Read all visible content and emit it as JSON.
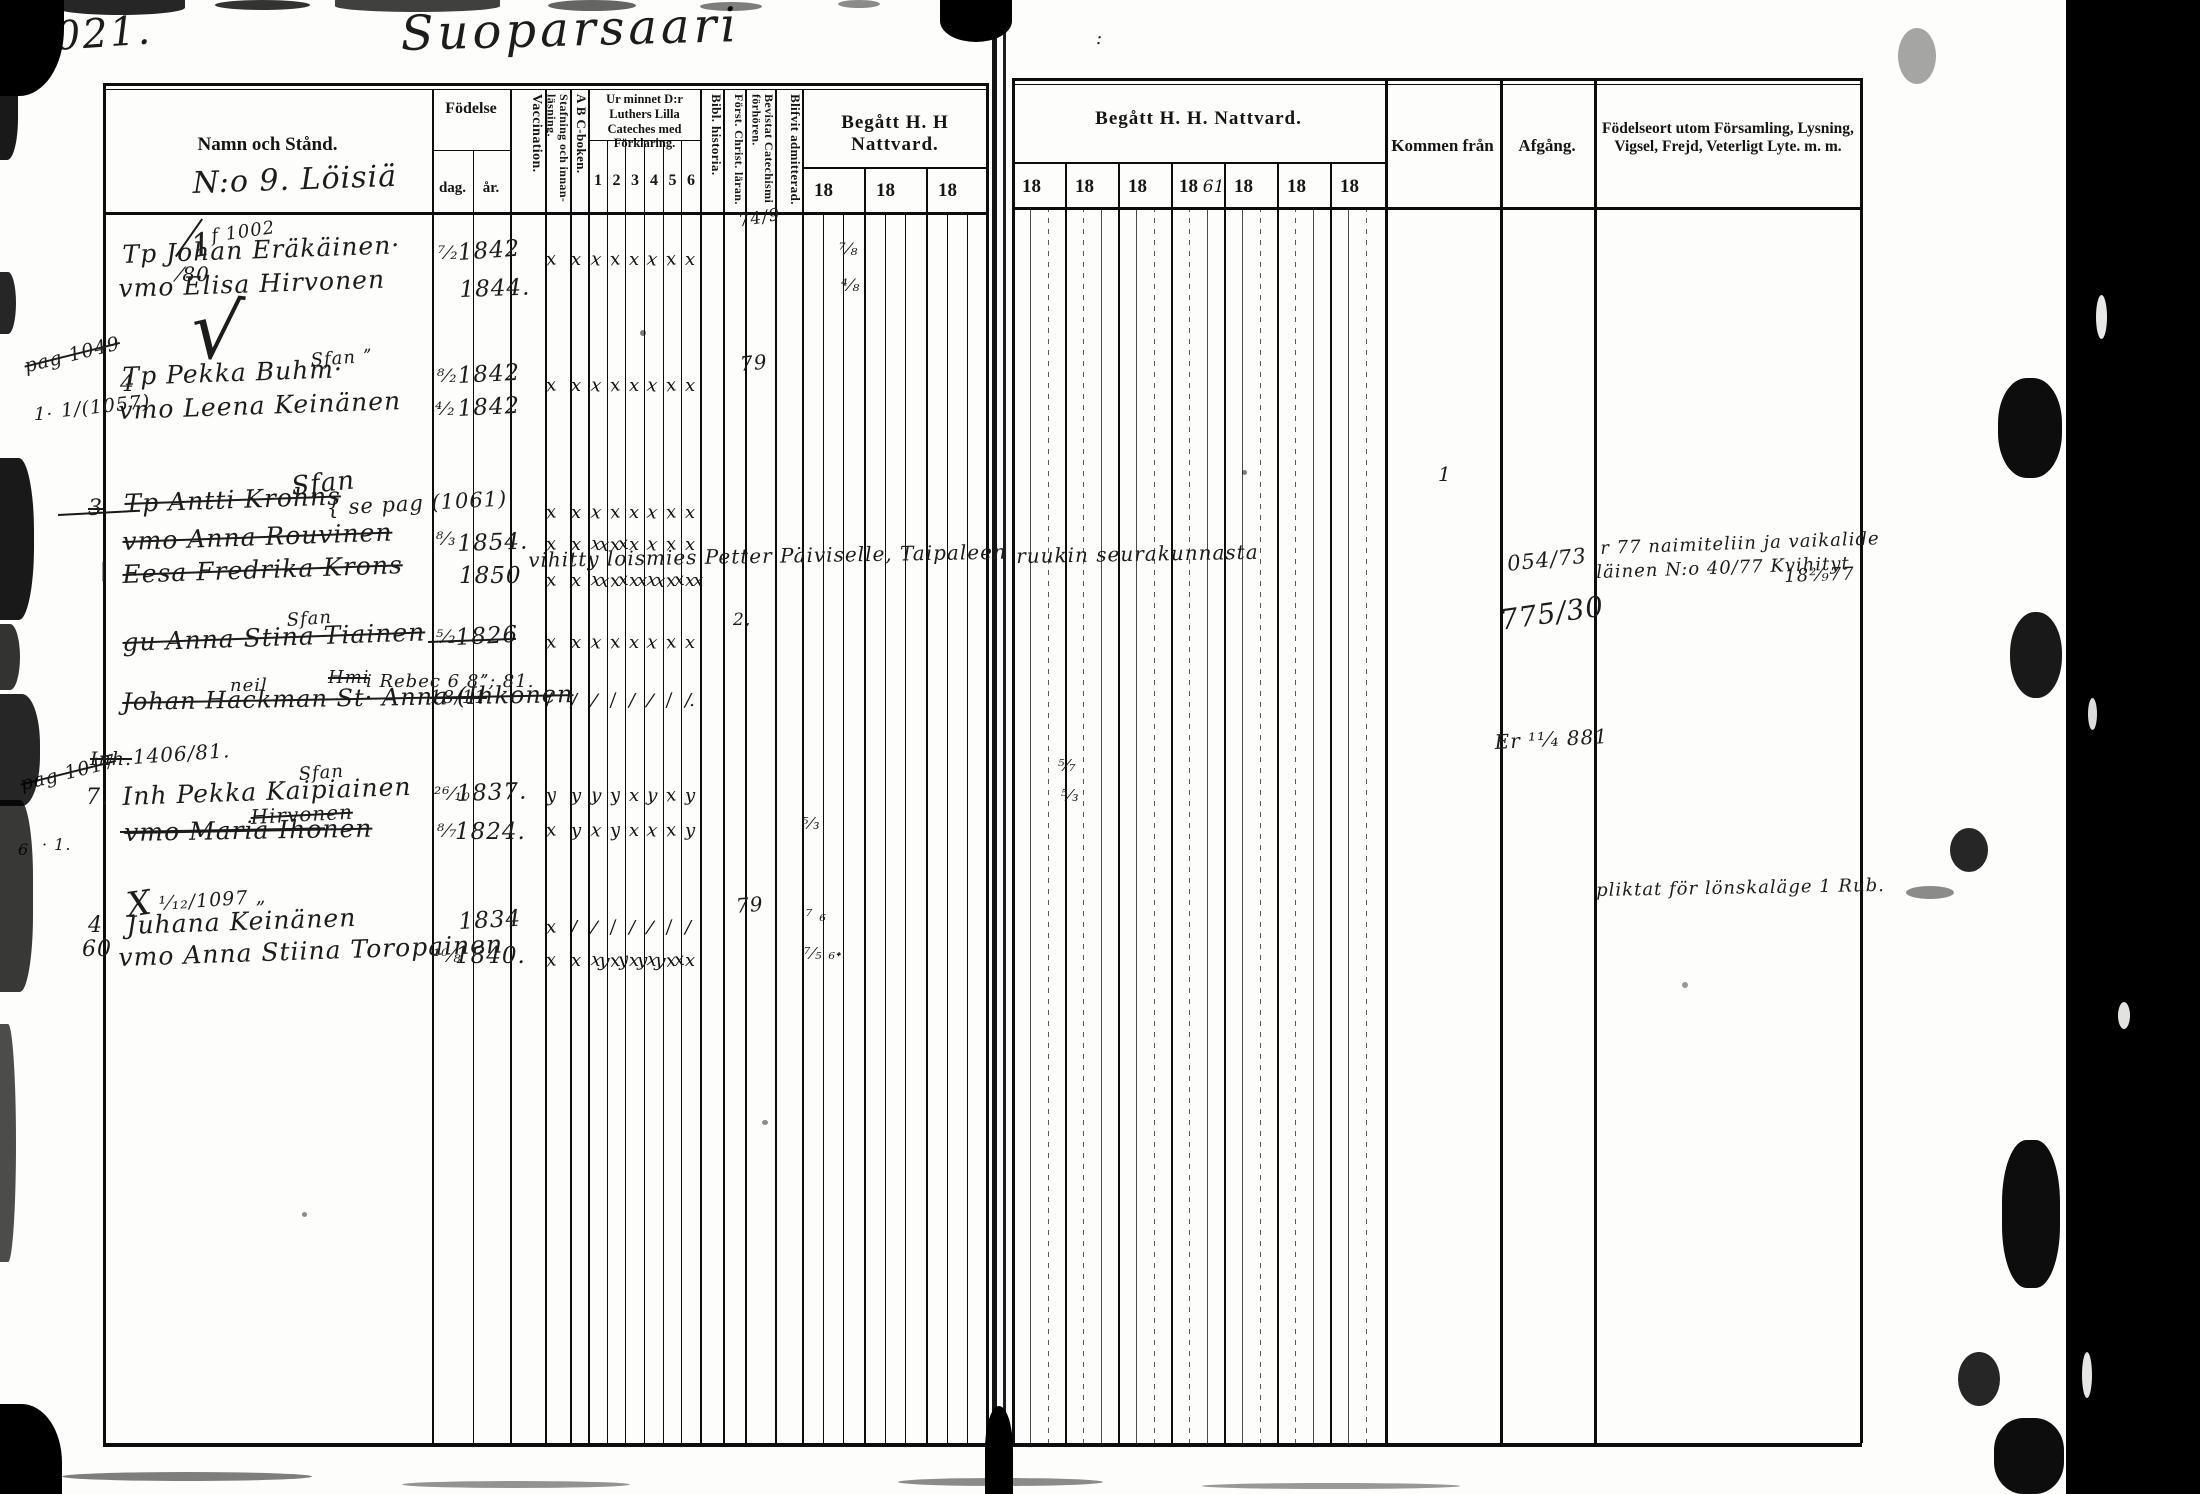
{
  "page": {
    "folio": "1021.",
    "title": "Suoparsaari"
  },
  "colors": {
    "ink": "#1c1c1c",
    "paper": "#fdfdfb",
    "scan_border": "#000000"
  },
  "lh": {
    "namn": "Namn och Stånd.",
    "namn_sub": "N:o 9. Löisiä",
    "fodelse": "Födelse",
    "dag": "dag.",
    "ar": "år.",
    "vacc": "Vaccination.",
    "staf": "Stafning och innan-läsning.",
    "abc": "A B C-boken.",
    "urminnet": "Ur minnet D:r Luthers Lilla Cateches med Förklaring.",
    "cols": [
      "1",
      "2",
      "3",
      "4",
      "5",
      "6"
    ],
    "bibl": "Bibl. historia.",
    "forst": "Först. Christ. läran.",
    "bev": "Bevistat Catechismi förhören.",
    "blif": "Blifvit admitterad.",
    "begatt": "Begått H. H Nattvard.",
    "years": [
      "18",
      "18",
      "18"
    ]
  },
  "rh": {
    "begatt": "Begått H. H. Nattvard.",
    "years": [
      "18",
      "18",
      "18",
      "18",
      "18",
      "18",
      "18"
    ],
    "year4_note": "61",
    "kommen": "Kommen från",
    "afgang": "Afgång.",
    "fodelseort1": "Födelseort utom Församling, Lysning,",
    "fodelseort2": "Vigsel, Frejd, Veterligt Lyte. m. m."
  },
  "handwriting": [
    {
      "x": 210,
      "y": 226,
      "t": "f 1002",
      "fs": 18,
      "r": -8
    },
    {
      "x": 122,
      "y": 240,
      "t": "Tp Johan Eräkäinen·",
      "fs": 25,
      "r": -2
    },
    {
      "x": 438,
      "y": 243,
      "t": "⁷⁄₂",
      "fs": 18
    },
    {
      "x": 457,
      "y": 240,
      "t": "1842",
      "fs": 23,
      "r": -4
    },
    {
      "x": 118,
      "y": 274,
      "t": "vmo Elisa Hirvonen",
      "fs": 25,
      "r": -2
    },
    {
      "x": 459,
      "y": 277,
      "t": "1844.",
      "fs": 23,
      "r": -2
    },
    {
      "x": 196,
      "y": 282,
      "t": "√",
      "fs": 80,
      "r": 6
    },
    {
      "x": 188,
      "y": 228,
      "t": "1",
      "fs": 32,
      "r": -10
    },
    {
      "x": 178,
      "y": 262,
      "t": "⁄80",
      "fs": 20
    },
    {
      "x": 22,
      "y": 356,
      "t": "pag 1049",
      "fs": 19,
      "r": -14,
      "s": 1
    },
    {
      "x": 120,
      "y": 372,
      "t": "4",
      "fs": 22
    },
    {
      "x": 34,
      "y": 404,
      "t": "1·",
      "fs": 18
    },
    {
      "x": 60,
      "y": 400,
      "t": "1/(1057)",
      "fs": 19,
      "r": -6
    },
    {
      "x": 122,
      "y": 362,
      "t": "Tp Pekka Buhm·",
      "fs": 25,
      "r": -2
    },
    {
      "x": 310,
      "y": 350,
      "t": "Sfan ˮ",
      "fs": 18,
      "r": -4
    },
    {
      "x": 437,
      "y": 366,
      "t": "⁸⁄₂",
      "fs": 18
    },
    {
      "x": 457,
      "y": 363,
      "t": "1842",
      "fs": 23,
      "r": -3
    },
    {
      "x": 118,
      "y": 396,
      "t": "vmo Leena Keinänen",
      "fs": 25,
      "r": -2
    },
    {
      "x": 435,
      "y": 399,
      "t": "⁴⁄₂",
      "fs": 18
    },
    {
      "x": 457,
      "y": 396,
      "t": "1842",
      "fs": 23,
      "r": -3
    },
    {
      "x": 88,
      "y": 496,
      "t": "3",
      "fs": 22,
      "s": 1
    },
    {
      "x": 124,
      "y": 489,
      "t": "Tp Antti Krohns",
      "fs": 25,
      "r": -2,
      "s": 1
    },
    {
      "x": 290,
      "y": 472,
      "t": "Sfan",
      "fs": 26,
      "r": -6
    },
    {
      "x": 326,
      "y": 496,
      "t": "{ se pag (1061)",
      "fs": 21,
      "r": -3
    },
    {
      "x": 122,
      "y": 527,
      "t": "vmo Anna Rouvinen",
      "fs": 25,
      "r": -2,
      "s": 1
    },
    {
      "x": 436,
      "y": 529,
      "t": "⁸⁄₃",
      "fs": 18
    },
    {
      "x": 457,
      "y": 531,
      "t": "1854.",
      "fs": 23,
      "r": -2
    },
    {
      "x": 122,
      "y": 560,
      "t": "Eesa Fredrika Krons",
      "fs": 25,
      "r": -2,
      "s": 1
    },
    {
      "x": 459,
      "y": 563,
      "t": "1850",
      "fs": 23
    },
    {
      "x": 100,
      "y": 558,
      "t": "|",
      "fs": 20
    },
    {
      "x": 286,
      "y": 610,
      "t": "Sfan",
      "fs": 18,
      "r": -4
    },
    {
      "x": 122,
      "y": 628,
      "t": "gu Anna Stina Tiainen",
      "fs": 25,
      "r": -2,
      "s": 1
    },
    {
      "x": 436,
      "y": 627,
      "t": "⁵⁄₂",
      "fs": 18
    },
    {
      "x": 455,
      "y": 625,
      "t": "1826",
      "fs": 23,
      "r": -3
    },
    {
      "x": 230,
      "y": 675,
      "t": "neil",
      "fs": 18
    },
    {
      "x": 328,
      "y": 667,
      "t": "Hmi",
      "fs": 18,
      "s": 1
    },
    {
      "x": 366,
      "y": 671,
      "t": "i Rebec 6 8ˮ; 81.",
      "fs": 18
    },
    {
      "x": 122,
      "y": 688,
      "t": "Johan Hackman St· Anna (Ihkonen",
      "fs": 24,
      "r": -1,
      "s": 1
    },
    {
      "x": 430,
      "y": 687,
      "t": "18/11",
      "fs": 18,
      "s": 1
    },
    {
      "x": 90,
      "y": 748,
      "t": "Inh.",
      "fs": 19,
      "s": 1
    },
    {
      "x": 132,
      "y": 745,
      "t": "1406/81.",
      "fs": 20,
      "r": -4
    },
    {
      "x": 18,
      "y": 774,
      "t": "pag 1017",
      "fs": 19,
      "r": -14,
      "s": 1
    },
    {
      "x": 86,
      "y": 785,
      "t": "7.",
      "fs": 22
    },
    {
      "x": 122,
      "y": 782,
      "t": "Inh Pekka Kaipiainen",
      "fs": 25,
      "r": -2
    },
    {
      "x": 298,
      "y": 764,
      "t": "Sfan",
      "fs": 18,
      "r": -4
    },
    {
      "x": 434,
      "y": 784,
      "t": "²⁶⁄₁₀",
      "fs": 18
    },
    {
      "x": 456,
      "y": 781,
      "t": "1837.",
      "fs": 23,
      "r": -2
    },
    {
      "x": 250,
      "y": 805,
      "t": "Hirvonen",
      "fs": 20,
      "r": -3,
      "s": 1
    },
    {
      "x": 124,
      "y": 818,
      "t": "vmo Maria Ihonen",
      "fs": 25,
      "r": -1,
      "s": 1
    },
    {
      "x": 437,
      "y": 821,
      "t": "⁸⁄₇",
      "fs": 18
    },
    {
      "x": 455,
      "y": 819,
      "t": "1824.",
      "fs": 23
    },
    {
      "x": 18,
      "y": 840,
      "t": "6",
      "fs": 16
    },
    {
      "x": 42,
      "y": 835,
      "t": "· 1.",
      "fs": 16
    },
    {
      "x": 124,
      "y": 886,
      "t": "X",
      "fs": 34,
      "r": -8
    },
    {
      "x": 158,
      "y": 893,
      "t": "¹⁄₁₂/1097 „",
      "fs": 19,
      "r": -4
    },
    {
      "x": 88,
      "y": 913,
      "t": "4",
      "fs": 22
    },
    {
      "x": 82,
      "y": 937,
      "t": "60",
      "fs": 22
    },
    {
      "x": 126,
      "y": 911,
      "t": "Juhana Keinänen",
      "fs": 25,
      "r": -2
    },
    {
      "x": 458,
      "y": 909,
      "t": "1834",
      "fs": 23,
      "r": -3
    },
    {
      "x": 118,
      "y": 943,
      "t": "vmo Anna Stiina Toropainen",
      "fs": 25,
      "r": -2
    },
    {
      "x": 433,
      "y": 946,
      "t": "¹⁰⁄₈",
      "fs": 18
    },
    {
      "x": 455,
      "y": 943,
      "t": "1840.",
      "fs": 23
    },
    {
      "x": 528,
      "y": 548,
      "t": "vihitty loismies Petter Päiviselle, Taipaleen",
      "fs": 20,
      "r": -1
    },
    {
      "x": 1016,
      "y": 544,
      "t": "ruukin seurakunnasta",
      "fs": 20,
      "r": -1
    },
    {
      "x": 737,
      "y": 212,
      "t": "74/9·",
      "fs": 17,
      "r": -10
    },
    {
      "x": 839,
      "y": 240,
      "t": "⁷⁄₈",
      "fs": 17
    },
    {
      "x": 841,
      "y": 276,
      "t": "⁴⁄₈",
      "fs": 17
    },
    {
      "x": 739,
      "y": 352,
      "t": "79",
      "fs": 20,
      "r": -5
    },
    {
      "x": 733,
      "y": 610,
      "t": "2,",
      "fs": 17
    },
    {
      "x": 802,
      "y": 814,
      "t": "⁵⁄₃",
      "fs": 16
    },
    {
      "x": 1058,
      "y": 756,
      "t": "⁵⁄₇",
      "fs": 16
    },
    {
      "x": 1061,
      "y": 786,
      "t": "⁵⁄₃",
      "fs": 16
    },
    {
      "x": 735,
      "y": 894,
      "t": "79",
      "fs": 20,
      "r": -5
    },
    {
      "x": 806,
      "y": 906,
      "t": "⁷ ₆",
      "fs": 16
    },
    {
      "x": 804,
      "y": 944,
      "t": "⁷⁄₅ ₆˖",
      "fs": 16
    },
    {
      "x": 1438,
      "y": 462,
      "t": "1",
      "fs": 20
    },
    {
      "x": 1506,
      "y": 552,
      "t": "054/73",
      "fs": 21,
      "r": -6
    },
    {
      "x": 1498,
      "y": 604,
      "t": "775/30",
      "fs": 28,
      "r": -8
    },
    {
      "x": 1494,
      "y": 730,
      "t": "Er ¹¹⁄₄ 881",
      "fs": 20,
      "r": -3
    },
    {
      "x": 1600,
      "y": 538,
      "t": "r 77 naimiteliin ja vaikalide",
      "fs": 18,
      "r": -2
    },
    {
      "x": 1596,
      "y": 562,
      "t": "läinen N:o 40/77 Kvihityt",
      "fs": 18,
      "r": -2
    },
    {
      "x": 1784,
      "y": 566,
      "t": "18²⁄₉77",
      "fs": 18,
      "r": -2
    },
    {
      "x": 1596,
      "y": 880,
      "t": "pliktat för lönskaläge 1 Rub.",
      "fs": 18,
      "r": -1
    },
    {
      "x": 1096,
      "y": 28,
      "t": ":",
      "fs": 18
    }
  ],
  "marks": {
    "cols": [
      546,
      571,
      591,
      610,
      629,
      647,
      666,
      685
    ],
    "rows": [
      {
        "y": 249,
        "g": [
          "x",
          "x",
          "x",
          "x",
          "x",
          "x",
          "x",
          "x"
        ]
      },
      {
        "y": 375,
        "g": [
          "x",
          "x",
          "x",
          "x",
          "x",
          "x",
          "x",
          "x"
        ]
      },
      {
        "y": 502,
        "g": [
          "x",
          "x",
          "x",
          "x",
          "x",
          "x",
          "x",
          "x"
        ]
      },
      {
        "y": 534,
        "g": [
          "x",
          "x",
          "xx",
          "xx",
          "x",
          "x",
          "x",
          "x"
        ]
      },
      {
        "y": 570,
        "g": [
          "x",
          "x",
          "xx",
          "xx",
          "xx",
          "xx",
          "xx",
          "xx"
        ]
      },
      {
        "y": 632,
        "g": [
          "x",
          "x",
          "x",
          "x",
          "x",
          "x",
          "x",
          "x"
        ]
      },
      {
        "y": 690,
        "g": [
          "/",
          "/",
          "/",
          "/",
          "/",
          "/",
          "/",
          "/."
        ]
      },
      {
        "y": 785,
        "g": [
          "y",
          "y",
          "y",
          "y",
          "x",
          "y",
          "x",
          "y"
        ]
      },
      {
        "y": 820,
        "g": [
          "x",
          "y",
          "x",
          "y",
          "x",
          "x",
          "x",
          "y"
        ]
      },
      {
        "y": 917,
        "g": [
          "x",
          "/",
          "/",
          "/",
          "/",
          "/",
          "/",
          "/"
        ]
      },
      {
        "y": 950,
        "g": [
          "x",
          "x",
          "xy",
          "xy",
          "xy",
          "xy",
          "xx",
          "x"
        ]
      }
    ]
  },
  "strikes": [
    {
      "x": 175,
      "y": 256,
      "w": 46,
      "r": -55
    },
    {
      "x": 120,
      "y": 831,
      "w": 205,
      "r": -1
    },
    {
      "x": 58,
      "y": 514,
      "w": 82,
      "r": -3
    },
    {
      "x": 428,
      "y": 641,
      "w": 88,
      "r": -2
    }
  ],
  "noise": [
    {
      "x": 0,
      "y": 0,
      "w": 64,
      "h": 96,
      "br": "0 0 70% 0",
      "o": 1
    },
    {
      "x": 0,
      "y": 90,
      "w": 18,
      "h": 70,
      "br": "0 0 60% 0",
      "o": 0.9
    },
    {
      "x": 55,
      "y": 0,
      "w": 130,
      "h": 15,
      "br": "0 0 50% 50%",
      "o": 0.85
    },
    {
      "x": 215,
      "y": 0,
      "w": 95,
      "h": 10,
      "br": "50%",
      "o": 0.8
    },
    {
      "x": 335,
      "y": 0,
      "w": 165,
      "h": 12,
      "br": "0 0 50% 50%",
      "o": 0.75
    },
    {
      "x": 548,
      "y": 0,
      "w": 88,
      "h": 11,
      "br": "50%",
      "o": 0.6
    },
    {
      "x": 700,
      "y": 2,
      "w": 62,
      "h": 9,
      "br": "50%",
      "o": 0.5
    },
    {
      "x": 838,
      "y": 0,
      "w": 42,
      "h": 8,
      "br": "50%",
      "o": 0.45
    },
    {
      "x": 940,
      "y": 0,
      "w": 72,
      "h": 42,
      "br": "0 0 60% 60%",
      "o": 1
    },
    {
      "x": 0,
      "y": 272,
      "w": 16,
      "h": 62,
      "br": "0 55% 55% 0",
      "o": 0.85
    },
    {
      "x": 0,
      "y": 458,
      "w": 34,
      "h": 162,
      "br": "0 45% 45% 0",
      "o": 0.9
    },
    {
      "x": 0,
      "y": 624,
      "w": 20,
      "h": 66,
      "br": "0 50% 50% 0",
      "o": 0.8
    },
    {
      "x": 0,
      "y": 694,
      "w": 40,
      "h": 112,
      "br": "0 45% 45% 0",
      "o": 0.85
    },
    {
      "x": 0,
      "y": 800,
      "w": 33,
      "h": 192,
      "br": "0 40% 40% 0",
      "o": 0.78
    },
    {
      "x": 0,
      "y": 1024,
      "w": 16,
      "h": 238,
      "br": "0 55% 55% 0",
      "o": 0.7
    },
    {
      "x": 0,
      "y": 1404,
      "w": 62,
      "h": 90,
      "br": "0 65% 0 0",
      "o": 1
    },
    {
      "x": 985,
      "y": 1406,
      "w": 28,
      "h": 88,
      "br": "55% 55% 0 0",
      "o": 1
    },
    {
      "x": 62,
      "y": 1472,
      "w": 250,
      "h": 9,
      "br": "50%",
      "o": 0.5
    },
    {
      "x": 402,
      "y": 1481,
      "w": 228,
      "h": 7,
      "br": "50%",
      "o": 0.42
    },
    {
      "x": 898,
      "y": 1478,
      "w": 205,
      "h": 8,
      "br": "50%",
      "o": 0.45
    },
    {
      "x": 1202,
      "y": 1483,
      "w": 258,
      "h": 6,
      "br": "50%",
      "o": 0.4
    },
    {
      "x": 2066,
      "y": 0,
      "w": 134,
      "h": 1494,
      "br": "0",
      "o": 1
    },
    {
      "x": 2096,
      "y": 295,
      "w": 11,
      "h": 44,
      "br": "50%",
      "o": 1,
      "c": "#e8e8e6"
    },
    {
      "x": 2088,
      "y": 698,
      "w": 9,
      "h": 32,
      "br": "50%",
      "o": 1,
      "c": "#dcdcda"
    },
    {
      "x": 2118,
      "y": 1002,
      "w": 12,
      "h": 27,
      "br": "50%",
      "o": 1,
      "c": "#e2e2e0"
    },
    {
      "x": 2082,
      "y": 1352,
      "w": 10,
      "h": 46,
      "br": "50%",
      "o": 1,
      "c": "#e6e6e4"
    },
    {
      "x": 1998,
      "y": 378,
      "w": 64,
      "h": 100,
      "br": "45%",
      "o": 0.95
    },
    {
      "x": 2010,
      "y": 612,
      "w": 52,
      "h": 86,
      "br": "48%",
      "o": 0.9
    },
    {
      "x": 1950,
      "y": 828,
      "w": 38,
      "h": 44,
      "br": "50%",
      "o": 0.85
    },
    {
      "x": 2002,
      "y": 1140,
      "w": 58,
      "h": 148,
      "br": "42%",
      "o": 0.95
    },
    {
      "x": 1958,
      "y": 1352,
      "w": 42,
      "h": 54,
      "br": "50%",
      "o": 0.85
    },
    {
      "x": 1994,
      "y": 1418,
      "w": 70,
      "h": 76,
      "br": "42%",
      "o": 0.95
    },
    {
      "x": 1898,
      "y": 28,
      "w": 38,
      "h": 56,
      "br": "50%",
      "o": 0.35
    },
    {
      "x": 1906,
      "y": 886,
      "w": 48,
      "h": 13,
      "br": "50%",
      "o": 0.45
    },
    {
      "x": 640,
      "y": 330,
      "w": 6,
      "h": 6,
      "br": "50%",
      "o": 0.5
    },
    {
      "x": 1242,
      "y": 470,
      "w": 5,
      "h": 5,
      "br": "50%",
      "o": 0.5
    },
    {
      "x": 762,
      "y": 1120,
      "w": 6,
      "h": 5,
      "br": "50%",
      "o": 0.45
    },
    {
      "x": 302,
      "y": 1212,
      "w": 5,
      "h": 5,
      "br": "50%",
      "o": 0.45
    },
    {
      "x": 1682,
      "y": 982,
      "w": 6,
      "h": 6,
      "br": "50%",
      "o": 0.4
    }
  ]
}
